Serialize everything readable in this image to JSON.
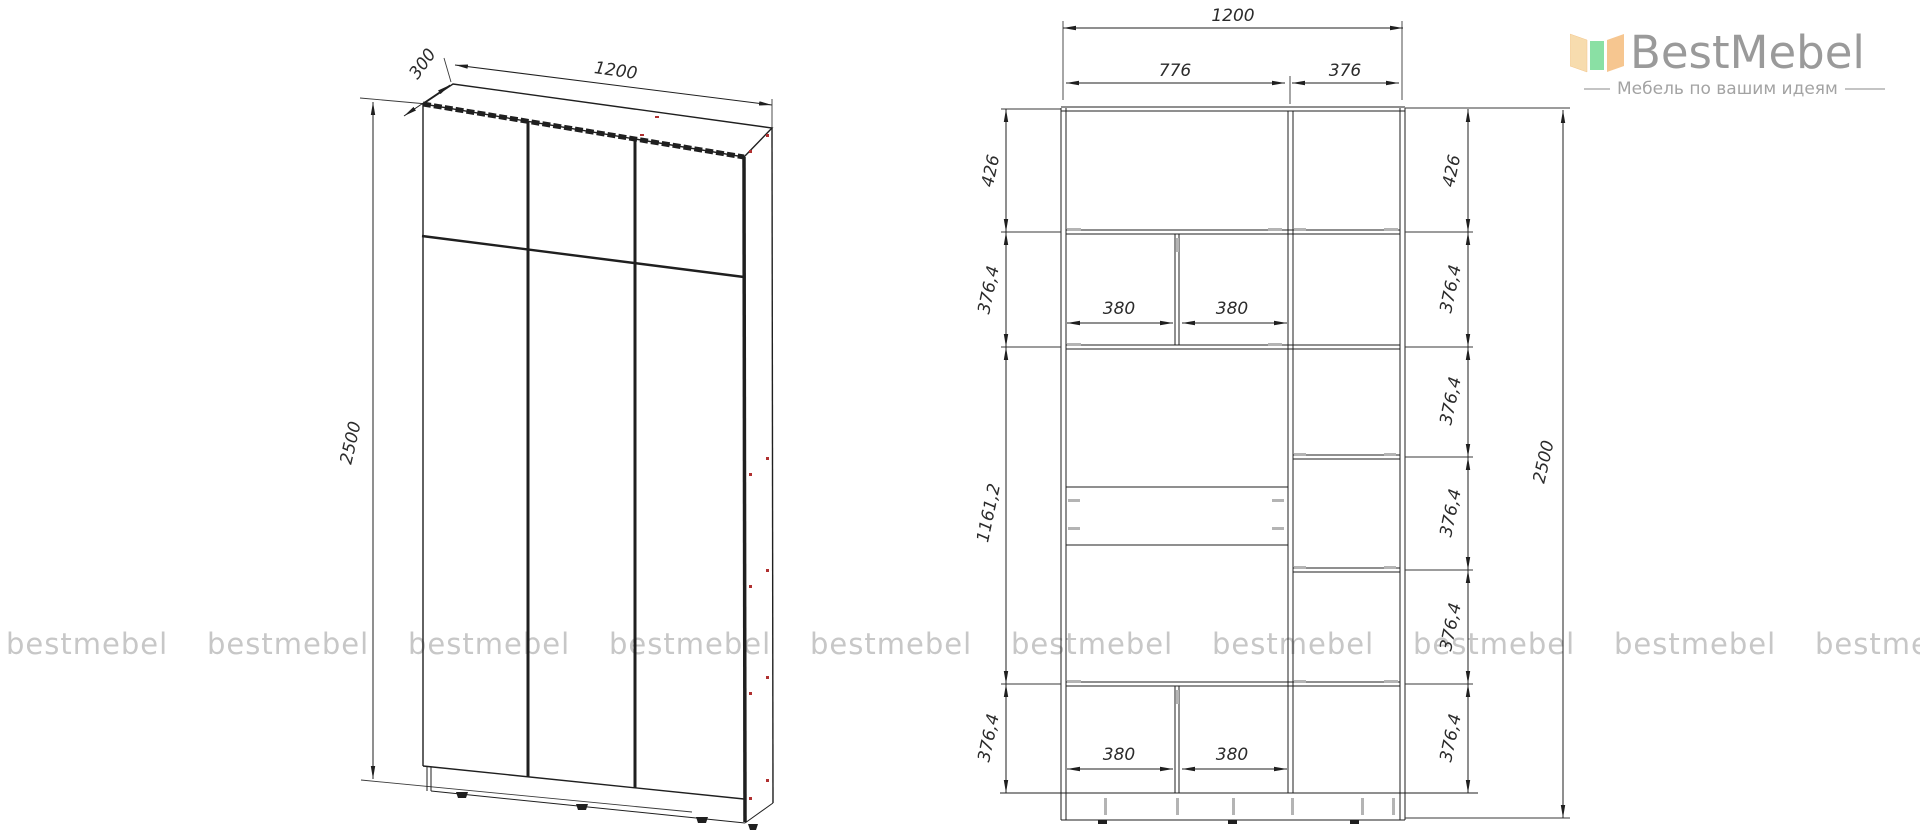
{
  "brand": {
    "name": "BestMebel",
    "tagline": "Мебель по вашим идеям"
  },
  "watermark": {
    "text": "bestmebel"
  },
  "left_view": {
    "depth": "300",
    "width": "1200",
    "height": "2500"
  },
  "front_view": {
    "width_total": "1200",
    "width_left": "776",
    "width_right": "376",
    "left_heights": [
      "426",
      "376,4",
      "1161,2",
      "376,4"
    ],
    "right_heights": [
      "426",
      "376,4",
      "376,4",
      "376,4",
      "376,4",
      "376,4"
    ],
    "height_total": "2500",
    "upper_widths": [
      "380",
      "380"
    ],
    "lower_widths": [
      "380",
      "380"
    ]
  },
  "colors": {
    "line": "#1f1f1f",
    "dim_text": "#2b2b2b",
    "watermark": "#c7c7c7",
    "logo_text": "#9a9a9a",
    "logo_tagline": "#a3a3a3",
    "accent_red": "#b03030",
    "connector_gray": "#b4b4b4",
    "logo_orange": "#f6c690",
    "logo_green": "#8ae0a4"
  }
}
